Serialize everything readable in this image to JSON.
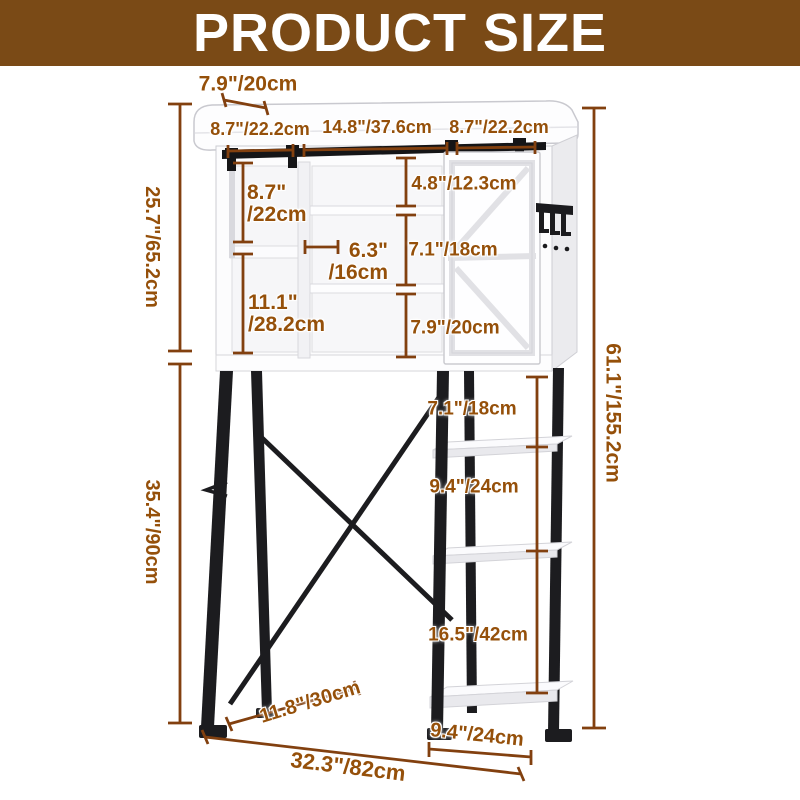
{
  "header": {
    "title": "PRODUCT SIZE"
  },
  "theme": {
    "banner_bg": "#7a4a16",
    "dimension_text_color": "#95500a",
    "dimension_line_color": "#82400f",
    "metal_color": "#1c1c1f",
    "cabinet_color": "#fdfdfe"
  },
  "dimensions": {
    "top_depth": "7.9\"/20cm",
    "top_width_left": "8.7\"/22.2cm",
    "top_width_middle": "14.8\"/37.6cm",
    "top_width_right": "8.7\"/22.2cm",
    "cabinet_height": "25.7\"/65.2cm",
    "stand_height": "35.4\"/90cm",
    "total_height": "61.1\"/155.2cm",
    "left_upper_inch": "8.7\"",
    "left_upper_cm": "/22cm",
    "left_lower_inch": "11.1\"",
    "left_lower_cm": "/28.2cm",
    "middle_shelf_inch": "6.3\"",
    "middle_shelf_cm": "/16cm",
    "center_gap_top": "4.8\"/12.3cm",
    "center_gap_middle": "7.1\"/18cm",
    "center_gap_bottom": "7.9\"/20cm",
    "ladder_gap_top": "7.1\"/18cm",
    "ladder_gap_middle": "9.4\"/24cm",
    "ladder_gap_bottom": "16.5\"/42cm",
    "base_depth": "11.8\"/30cm",
    "base_shelf_width": "9.4\"/24cm",
    "total_width": "32.3\"/82cm"
  }
}
